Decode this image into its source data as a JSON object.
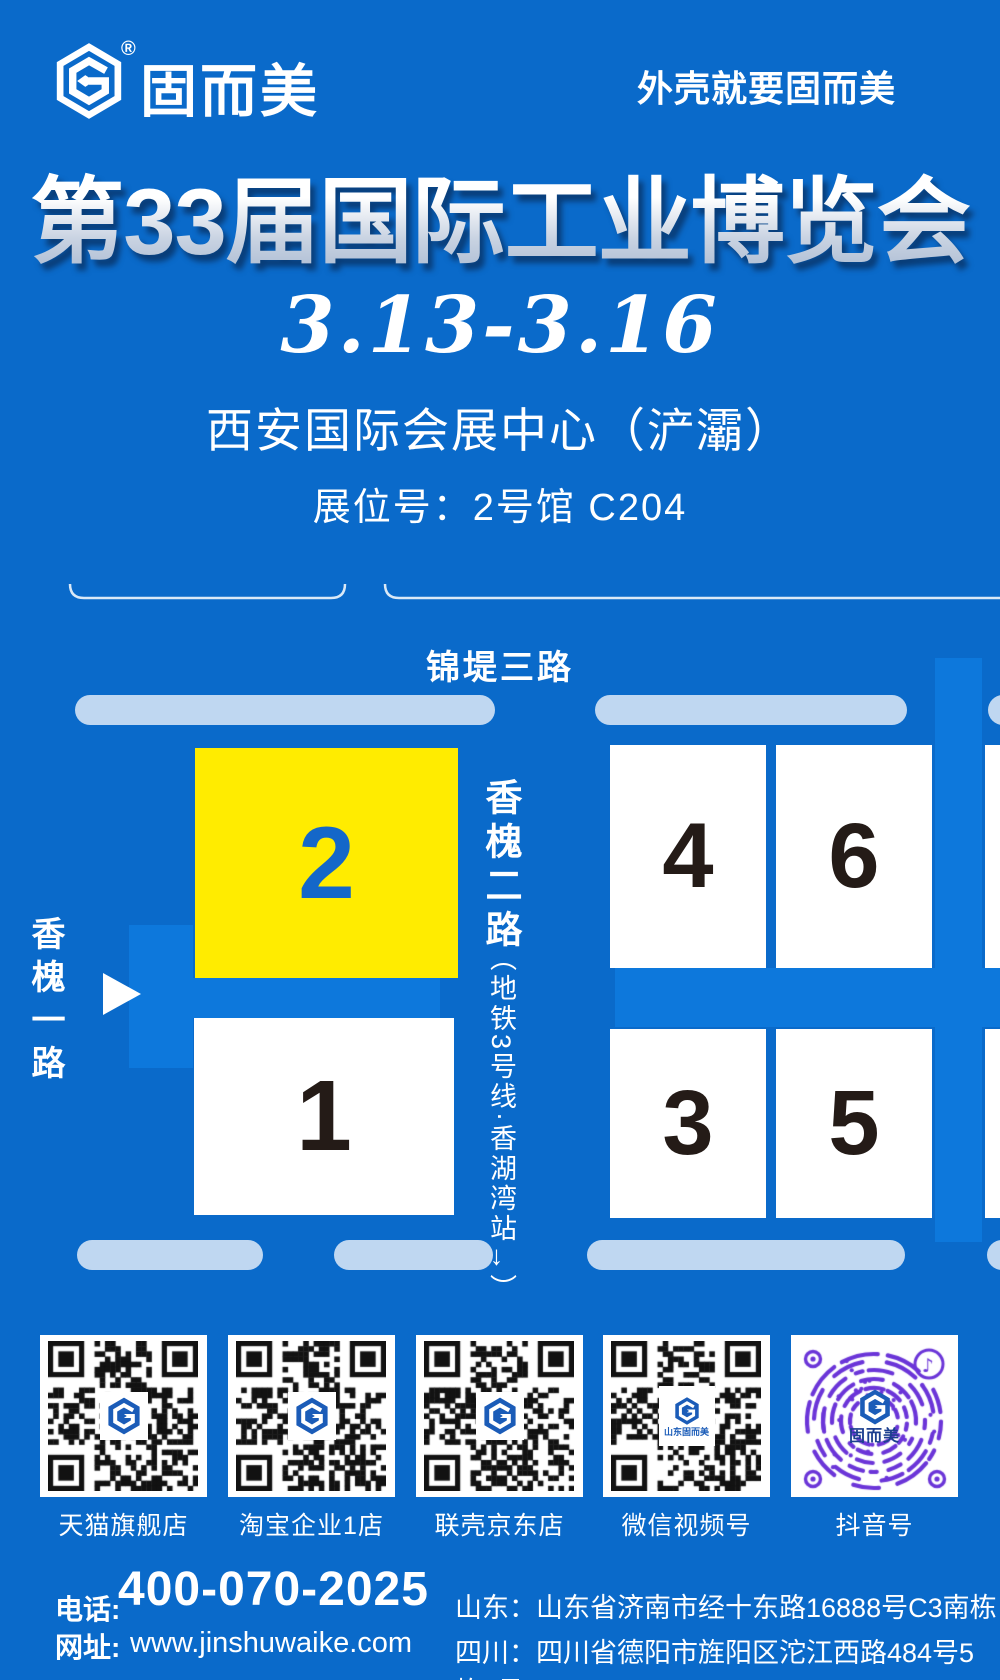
{
  "header": {
    "brand": "固而美",
    "reg": "®",
    "tagline": "外壳就要固而美"
  },
  "hero": {
    "title": "第33届国际工业博览会",
    "date": "3.13-3.16",
    "venue": "西安国际会展中心（浐灞）",
    "booth": "展位号：2号馆 C204"
  },
  "map": {
    "top_road": "锦堤三路",
    "left_road": "香槐一路",
    "mid_road": "香槐二路",
    "mid_road_note": "（地铁3号线·香湖湾站→）",
    "halls": [
      {
        "num": "2",
        "highlight": true
      },
      {
        "num": "4"
      },
      {
        "num": "6"
      },
      {
        "num": "1"
      },
      {
        "num": "3"
      },
      {
        "num": "5"
      }
    ]
  },
  "qr": {
    "items": [
      {
        "label": "天猫旗舰店"
      },
      {
        "label": "淘宝企业1店"
      },
      {
        "label": "联壳京东店"
      },
      {
        "label": "微信视频号"
      },
      {
        "label": "抖音号"
      }
    ],
    "wechat_center_text": "山东固而美",
    "douyin_center_text": "固而美",
    "douyin_reg": "®"
  },
  "footer": {
    "phone_label": "电话:",
    "phone": "400-070-2025",
    "web_label": "网址:",
    "web": "www.jinshuwaike.com",
    "addresses": [
      "山东：山东省济南市经十东路16888号C3南栋",
      "四川：四川省德阳市旌阳区沱江西路484号5栋4号"
    ]
  },
  "colors": {
    "bg": "#0a6aca",
    "road": "#0d78dc",
    "light_road": "#bfd7f1",
    "hall_yellow": "#ffec00",
    "hall_num": "#241b17",
    "hall2_num": "#1467c9",
    "qr_dark": "#121212",
    "douyin_purple": "#6b35d8",
    "logo_blue": "#1b5cb8"
  }
}
